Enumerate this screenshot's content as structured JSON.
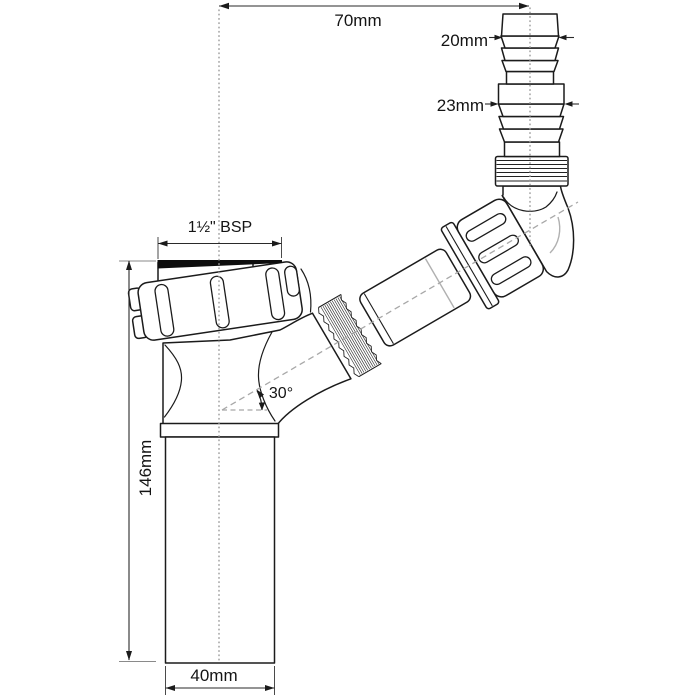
{
  "dims": {
    "top_offset": "70mm",
    "hose_tip": "20mm",
    "hose_step": "23mm",
    "thread": "1½\" BSP",
    "angle": "30°",
    "height": "146mm",
    "outlet": "40mm"
  },
  "colors": {
    "line": "#1b1b1b",
    "centerline": "#9e9e9e",
    "washer": "#0d0d0d",
    "background": "#ffffff"
  }
}
